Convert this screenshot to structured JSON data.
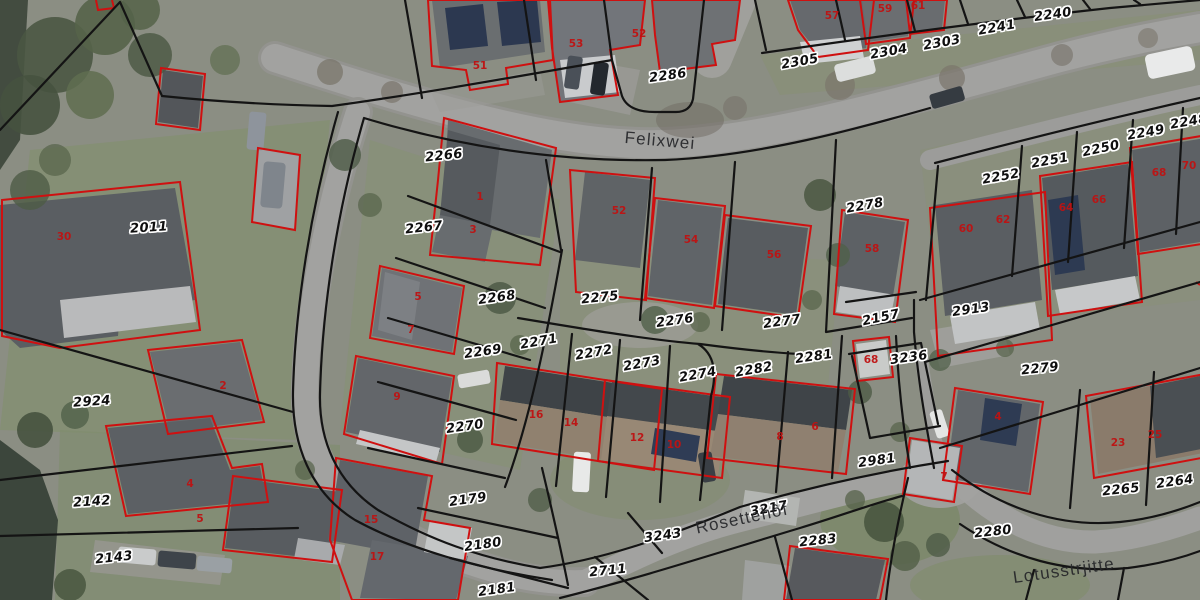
{
  "map": {
    "streets": [
      {
        "label": "Felixwei",
        "x": 660,
        "y": 141,
        "r": 5
      },
      {
        "label": "Rosettehôf",
        "x": 742,
        "y": 519,
        "r": -12
      },
      {
        "label": "Lotusstrjitte",
        "x": 1064,
        "y": 571,
        "r": -8
      }
    ],
    "parcels": [
      {
        "label": "2286",
        "x": 668,
        "y": 76,
        "r": -8
      },
      {
        "label": "2305",
        "x": 800,
        "y": 62,
        "r": -10
      },
      {
        "label": "2304",
        "x": 889,
        "y": 52,
        "r": -10
      },
      {
        "label": "2303",
        "x": 942,
        "y": 43,
        "r": -10
      },
      {
        "label": "2241",
        "x": 997,
        "y": 28,
        "r": -10
      },
      {
        "label": "2240",
        "x": 1053,
        "y": 15,
        "r": -8
      },
      {
        "label": "2248",
        "x": 1189,
        "y": 122,
        "r": -10
      },
      {
        "label": "2249",
        "x": 1146,
        "y": 133,
        "r": -10
      },
      {
        "label": "2250",
        "x": 1101,
        "y": 149,
        "r": -12
      },
      {
        "label": "2251",
        "x": 1050,
        "y": 161,
        "r": -10
      },
      {
        "label": "2252",
        "x": 1001,
        "y": 177,
        "r": -10
      },
      {
        "label": "2266",
        "x": 444,
        "y": 156,
        "r": -6
      },
      {
        "label": "2267",
        "x": 424,
        "y": 228,
        "r": -6
      },
      {
        "label": "2268",
        "x": 497,
        "y": 298,
        "r": -8
      },
      {
        "label": "2269",
        "x": 483,
        "y": 352,
        "r": -8
      },
      {
        "label": "2270",
        "x": 465,
        "y": 427,
        "r": -8
      },
      {
        "label": "2271",
        "x": 539,
        "y": 342,
        "r": -10
      },
      {
        "label": "2272",
        "x": 594,
        "y": 353,
        "r": -10
      },
      {
        "label": "2273",
        "x": 642,
        "y": 364,
        "r": -10
      },
      {
        "label": "2274",
        "x": 698,
        "y": 375,
        "r": -10
      },
      {
        "label": "2275",
        "x": 600,
        "y": 298,
        "r": -6
      },
      {
        "label": "2276",
        "x": 675,
        "y": 321,
        "r": -8
      },
      {
        "label": "2277",
        "x": 782,
        "y": 322,
        "r": -8
      },
      {
        "label": "2278",
        "x": 865,
        "y": 206,
        "r": -10
      },
      {
        "label": "2282",
        "x": 754,
        "y": 370,
        "r": -10
      },
      {
        "label": "2281",
        "x": 814,
        "y": 357,
        "r": -8
      },
      {
        "label": "2157",
        "x": 881,
        "y": 318,
        "r": -12
      },
      {
        "label": "3236",
        "x": 909,
        "y": 358,
        "r": -8
      },
      {
        "label": "2913",
        "x": 971,
        "y": 310,
        "r": -8
      },
      {
        "label": "2279",
        "x": 1040,
        "y": 369,
        "r": -6
      },
      {
        "label": "2011",
        "x": 149,
        "y": 228,
        "r": -4
      },
      {
        "label": "2924",
        "x": 92,
        "y": 402,
        "r": -4
      },
      {
        "label": "2142",
        "x": 92,
        "y": 502,
        "r": -4
      },
      {
        "label": "2143",
        "x": 114,
        "y": 558,
        "r": -6
      },
      {
        "label": "2179",
        "x": 468,
        "y": 500,
        "r": -8
      },
      {
        "label": "2180",
        "x": 483,
        "y": 545,
        "r": -8
      },
      {
        "label": "2181",
        "x": 497,
        "y": 590,
        "r": -8
      },
      {
        "label": "2711",
        "x": 608,
        "y": 571,
        "r": -6
      },
      {
        "label": "3243",
        "x": 663,
        "y": 536,
        "r": -8
      },
      {
        "label": "3217",
        "x": 769,
        "y": 509,
        "r": -10
      },
      {
        "label": "2283",
        "x": 818,
        "y": 541,
        "r": -6
      },
      {
        "label": "2981",
        "x": 877,
        "y": 461,
        "r": -8
      },
      {
        "label": "2280",
        "x": 993,
        "y": 532,
        "r": -6
      },
      {
        "label": "2265",
        "x": 1121,
        "y": 490,
        "r": -6
      },
      {
        "label": "2264",
        "x": 1175,
        "y": 482,
        "r": -8
      }
    ],
    "buildings": [
      {
        "label": "51",
        "x": 480,
        "y": 66
      },
      {
        "label": "53",
        "x": 576,
        "y": 44
      },
      {
        "label": "52",
        "x": 639,
        "y": 34
      },
      {
        "label": "57",
        "x": 832,
        "y": 16
      },
      {
        "label": "59",
        "x": 885,
        "y": 9
      },
      {
        "label": "61",
        "x": 918,
        "y": 6
      },
      {
        "label": "30",
        "x": 64,
        "y": 237
      },
      {
        "label": "2",
        "x": 223,
        "y": 386
      },
      {
        "label": "1",
        "x": 480,
        "y": 197
      },
      {
        "label": "3",
        "x": 473,
        "y": 230
      },
      {
        "label": "5",
        "x": 418,
        "y": 297
      },
      {
        "label": "7",
        "x": 411,
        "y": 330
      },
      {
        "label": "9",
        "x": 397,
        "y": 397
      },
      {
        "label": "52",
        "x": 619,
        "y": 211
      },
      {
        "label": "54",
        "x": 691,
        "y": 240
      },
      {
        "label": "56",
        "x": 774,
        "y": 255
      },
      {
        "label": "58",
        "x": 872,
        "y": 249
      },
      {
        "label": "16",
        "x": 536,
        "y": 415
      },
      {
        "label": "14",
        "x": 571,
        "y": 423
      },
      {
        "label": "12",
        "x": 637,
        "y": 438
      },
      {
        "label": "10",
        "x": 674,
        "y": 445
      },
      {
        "label": "8",
        "x": 780,
        "y": 437
      },
      {
        "label": "6",
        "x": 815,
        "y": 427
      },
      {
        "label": "68",
        "x": 871,
        "y": 360
      },
      {
        "label": "60",
        "x": 966,
        "y": 229
      },
      {
        "label": "62",
        "x": 1003,
        "y": 220
      },
      {
        "label": "64",
        "x": 1066,
        "y": 208
      },
      {
        "label": "66",
        "x": 1099,
        "y": 200
      },
      {
        "label": "68",
        "x": 1159,
        "y": 173
      },
      {
        "label": "70",
        "x": 1189,
        "y": 166
      },
      {
        "label": "23",
        "x": 1118,
        "y": 443
      },
      {
        "label": "25",
        "x": 1155,
        "y": 435
      },
      {
        "label": "4",
        "x": 998,
        "y": 417
      },
      {
        "label": "7",
        "x": 944,
        "y": 477
      },
      {
        "label": "15",
        "x": 371,
        "y": 520
      },
      {
        "label": "17",
        "x": 377,
        "y": 557
      },
      {
        "label": "4",
        "x": 190,
        "y": 484
      },
      {
        "label": "5",
        "x": 200,
        "y": 519
      }
    ],
    "colors": {
      "parcel_line": "#141414",
      "building_outline": "#cf1010",
      "building_number": "#bf1212",
      "parcel_label": "#0e0e0e",
      "street_label": "#26272a",
      "road": "#a2a2a0",
      "grass": "#83906f",
      "water": "#3c463c"
    }
  }
}
